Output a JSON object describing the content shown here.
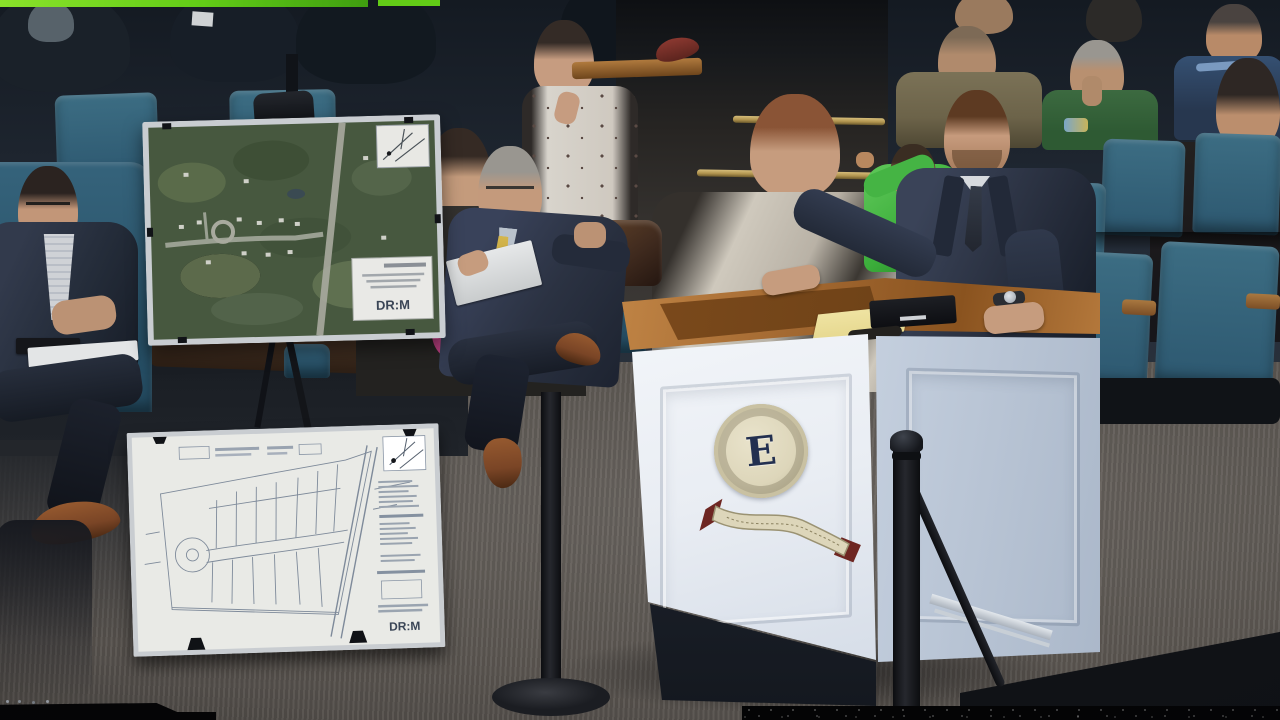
{
  "meta": {
    "title": "Public hearing — presenter at podium with site-plan display boards"
  },
  "texts": {
    "seal_letter": "E",
    "aerial_board_logo": "DR:M",
    "site_plan_logo": "DR:M"
  },
  "boards": {
    "aerial_map": {
      "kind": "aerial photo site-location map on easel",
      "logo": "DR:M"
    },
    "site_plan": {
      "kind": "white subdivision plat / engineering site plan",
      "logo": "DR:M"
    }
  },
  "podium": {
    "seal_letter": "E",
    "items": [
      "yellow legal pad",
      "laptop",
      "folded glasses"
    ]
  },
  "people": [
    {
      "label": "man seated far left, dark suit, glasses, papers on lap"
    },
    {
      "label": "woman with dark hair and magenta scarf behind aerial board"
    },
    {
      "label": "woman with auburn hair in cream jacket"
    },
    {
      "label": "young woman in white floral top"
    },
    {
      "label": "older man, gray hair, navy suit, yellow tie, reading plans"
    },
    {
      "label": "speaker at podium, navy suit, beard, wristwatch"
    },
    {
      "label": "child in bright green jacket behind podium"
    },
    {
      "label": "man in olive jacket"
    },
    {
      "label": "older man in green sweater, hand at mouth"
    },
    {
      "label": "man in navy jacket, far right"
    },
    {
      "label": "woman with dark bob, far right edge"
    }
  ],
  "colors": {
    "bg_dark": "#232b36",
    "bg_darker": "#141a22",
    "chair_teal": "#3c6d83",
    "chair_teal_dark": "#2d5870",
    "chair_teal_mid": "#35637b",
    "carpet": "#6a6560",
    "carpet_dark": "#45413e",
    "brass": "#b0934e",
    "podium_face": "#e9edf3",
    "podium_side": "#c3cedd",
    "wood": "#a0662f",
    "wood_dark": "#6e4217",
    "seal_cream": "#ddd6ba",
    "seal_navy": "#233050",
    "ribbon_red": "#6e2622",
    "suit_navy": "#2b3242",
    "skin": "#c69c7e",
    "hair_brown": "#5d3a22",
    "hair_gray": "#999690",
    "tie_yellow": "#c2a33a",
    "green_jacket": "#3cae3b",
    "olive": "#6c6349",
    "sweater_green": "#2e5a33",
    "navy_jacket": "#27374f",
    "cream_jacket": "#cfc9bd",
    "scarf_pink": "#b03a78",
    "paper": "#e3e5e6",
    "legal_pad": "#e6d88f",
    "bag_brown": "#3f2a1e",
    "shoe_brown": "#7a4526",
    "map_green": "#47583f",
    "plan_bg": "#e9eae6",
    "plan_line": "#7e8a9a",
    "frame_silver": "#c9cdd1",
    "glitch_green": "#62cc17",
    "stanchion": "#26282e"
  }
}
